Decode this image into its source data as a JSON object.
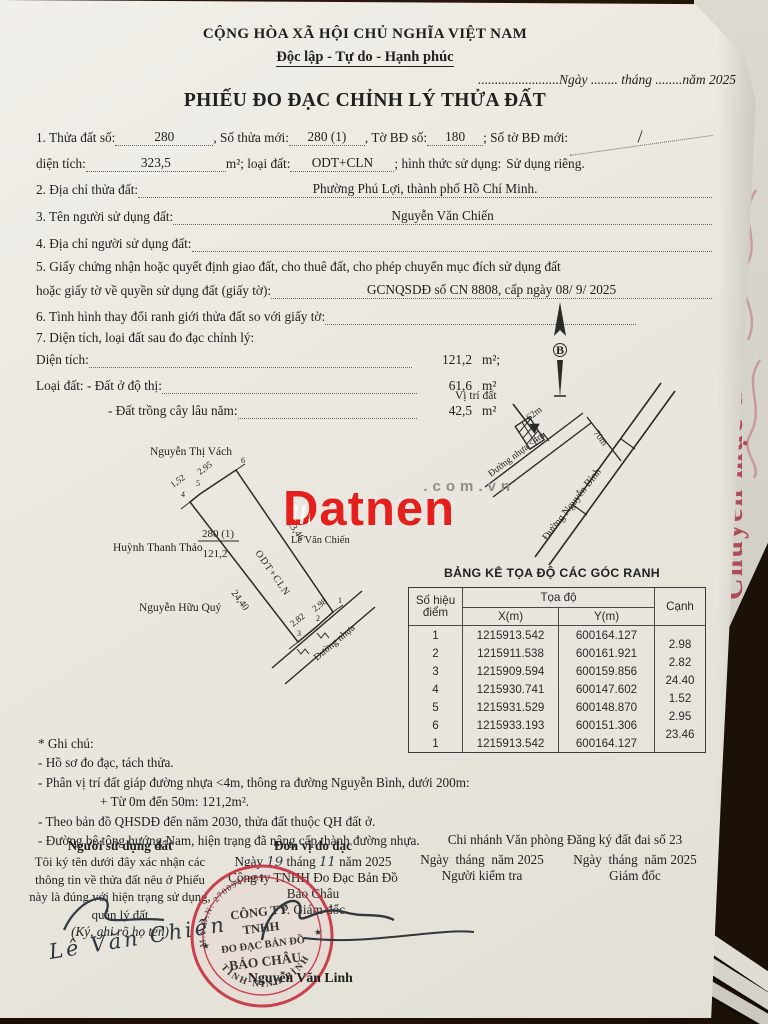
{
  "accent": {
    "stamp_red": "#c5303e",
    "watermark_red": "#e5201c",
    "side_red": "#a93344",
    "paper": "#eae7e0"
  },
  "header": {
    "national_title": "CỘNG HÒA XÃ HỘI CHỦ NGHĨA VIỆT NAM",
    "motto": "Độc lập - Tự do - Hạnh phúc",
    "date_line": "........................Ngày ........ tháng ........năm 2025",
    "doc_title": "PHIẾU ĐO ĐẠC CHỈNH LÝ THỬA ĐẤT"
  },
  "fields": {
    "item1_label": "1. Thửa đất số:",
    "parcel_no": "280",
    "new_parcel_label": ", Số thửa mới:",
    "new_parcel_no": "280 (1)",
    "sheet_label": ", Tờ BĐ số:",
    "sheet_no": "180",
    "new_sheet_label": "; Số tờ BĐ mới:",
    "new_sheet_no": "/",
    "area_label": "diện tích:",
    "area_value": "323,5",
    "area_mid_label": "m²; loại đất:",
    "land_type": "ODT+CLN",
    "usage_label": "; hình thức sử dụng:",
    "usage_value": "Sử dụng riêng.",
    "item2_label": "2. Địa chỉ thửa đất:",
    "address": "Phường Phú Lợi, thành phố Hồ Chí Minh.",
    "item3_label": "3. Tên người sử dụng đất:",
    "owner": "Nguyễn Văn Chiến",
    "item4_label": "4. Địa chỉ người sử dụng đất:",
    "item5_label_1": "5. Giấy chứng nhận hoặc quyết định giao đất, cho thuê đất, cho phép chuyển mục đích sử dụng đất",
    "item5_label_2": "hoặc giấy tờ về quyền sử dụng đất (giấy tờ):",
    "certificate": "GCNQSDĐ số CN 8808, cấp ngày 08/ 9/ 2025",
    "item6_label": "6. Tình hình thay đổi ranh giới thửa đất so với giấy tờ:",
    "item7_label": "7. Diện tích, loại đất sau đo đạc chỉnh lý:",
    "area7_label": "Diện tích:",
    "area7_value": "121,2",
    "area7_unit": "m²;",
    "landtype7_label": "Loại đất: - Đất ở độ thị:",
    "landtype7_value": "61,6",
    "landtype7_unit": "m²",
    "perennial_label": "- Đất trồng cây lâu năm:",
    "perennial_value": "42,5",
    "perennial_unit": "m²"
  },
  "north_arrow": {
    "letter": "B"
  },
  "location_sketch": {
    "label": "Vị trí đất",
    "road1": "Đường nhựa <4m",
    "dim_62": "62m",
    "dim_70": "70m",
    "road2": "Đường Nguyễn Bình"
  },
  "parcel_sketch": {
    "neighbor_top": "Nguyễn Thị Vách",
    "neighbor_left": "Huỳnh Thanh Thảo",
    "neighbor_bottom": "Nguyễn Hữu Quý",
    "neighbor_right": "Lê Văn Chiến",
    "parcel_no": "280 (1)",
    "parcel_area": "121,2",
    "parcel_type": "ODT+CLN",
    "side_right": "23,46",
    "side_left": "24,40",
    "edge_top_1": "1,52",
    "edge_top_2": "2,95",
    "edge_bottom_1": "2,82",
    "edge_bottom_2": "2,98",
    "v1": "1",
    "v2": "2",
    "v3": "3",
    "v4": "4",
    "v5": "5",
    "v6": "6",
    "road": "Đường nhựa"
  },
  "watermark": {
    "brand": "Datnen",
    "domain": ".com.vn"
  },
  "table": {
    "title": "BẢNG KÊ TỌA ĐỘ CÁC GÓC RANH",
    "col_point_l1": "Số hiệu",
    "col_point_l2": "điểm",
    "col_coord": "Tọa độ",
    "col_x": "X(m)",
    "col_y": "Y(m)",
    "col_edge": "Cạnh",
    "rows": [
      {
        "point": "1",
        "x": "1215913.542",
        "y": "600164.127"
      },
      {
        "point": "2",
        "x": "1215911.538",
        "y": "600161.921"
      },
      {
        "point": "3",
        "x": "1215909.594",
        "y": "600159.856"
      },
      {
        "point": "4",
        "x": "1215930.741",
        "y": "600147.602"
      },
      {
        "point": "5",
        "x": "1215931.529",
        "y": "600148.870"
      },
      {
        "point": "6",
        "x": "1215933.193",
        "y": "600151.306"
      },
      {
        "point": "1",
        "x": "1215913.542",
        "y": "600164.127"
      }
    ],
    "edges": [
      "2.98",
      "2.82",
      "24.40",
      "1.52",
      "2.95",
      "23.46"
    ]
  },
  "notes": {
    "title": "* Ghi chú:",
    "lines": [
      "- Hồ sơ đo đạc, tách thửa.",
      "- Phân vị trí đất giáp đường nhựa <4m, thông ra đường Nguyễn Bình, dưới 200m:",
      "+ Từ 0m đến 50m: 121,2m².",
      "- Theo bản đồ QHSDĐ đến năm 2030, thửa đất thuộc QH đất ở.",
      "- Đường bê tông hướng Nam, hiện trạng đã nâng cấp thành đường nhựa."
    ]
  },
  "signatures": {
    "col1_title": "Người sử dụng đất",
    "col1_body": "Tôi ký tên dưới đây xác nhận các thông tin về thửa đất nêu ở Phiếu này là đúng với hiện trạng sử dụng, quản lý đất",
    "col1_note": "(Ký, ghi rõ họ tên)",
    "col1_sign": "Lê Văn Chiến",
    "col2_title": "Đơn vị đo đạc",
    "date_w1": "Ngày",
    "col2_day": "19",
    "date_w2": "tháng",
    "col2_month": "11",
    "date_w3": "năm 2025",
    "col2_company": "Công ty TNHH Đo Đạc Bản Đồ",
    "col2_name": "Bảo Châu",
    "col2_role": "P. Giám đốc",
    "col2_signer": "Nguyễn Văn Linh",
    "col3_header": "Chi nhánh Văn phòng Đăng ký đất đai số 23",
    "col3_role": "Người kiểm tra",
    "col4_role": "Giám đốc"
  },
  "stamp": {
    "arc_top": "M.S.D.N: 2700947985",
    "line1": "CÔNG TY",
    "line2": "TNHH",
    "line3": "ĐO ĐẠC BẢN ĐỒ",
    "line4": "BẢO CHÂU",
    "arc_bottom": "TỈNH NINH BÌNH",
    "star": "★"
  },
  "side_page": {
    "red_text": "Chuyển mục đích"
  }
}
